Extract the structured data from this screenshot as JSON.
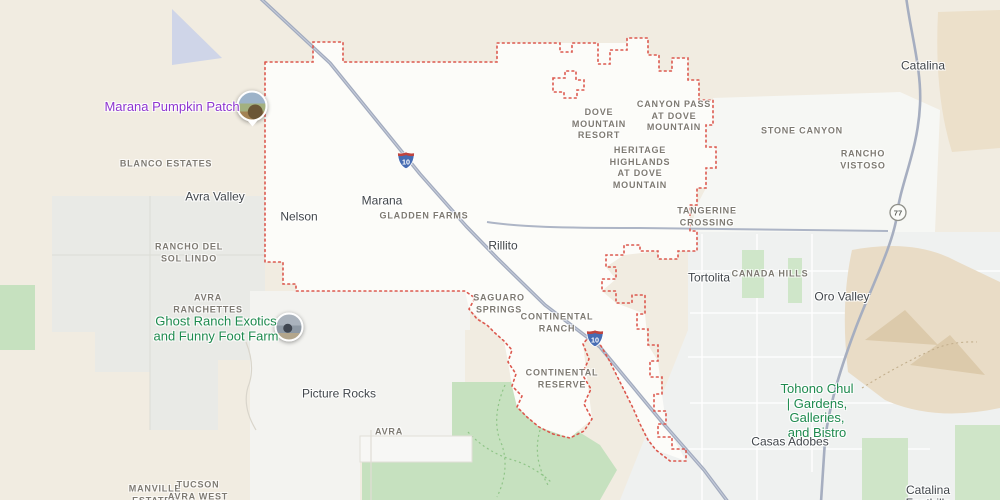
{
  "map": {
    "description": "road map with dotted municipal boundary",
    "colors": {
      "land": "#f1ece1",
      "urban_white": "#fcfcf9",
      "suburb_gray": "#eff1f0",
      "park_green": "#c6e1bf",
      "terrain_tan": "#e9dcc6",
      "blue_area": "#cfd5e8",
      "road_major": "#a2abbe",
      "boundary_red": "#dc584e",
      "poi_purple": "#8e35d0",
      "poi_green": "#1e8a4e"
    },
    "labels": [
      {
        "name": "marana-pumpkin-patch-label",
        "type": "poi-purple",
        "x": 172,
        "y": 107,
        "lines": [
          "Marana Pumpkin Patch"
        ]
      },
      {
        "name": "blanco-estates-label",
        "type": "area-caps",
        "x": 166,
        "y": 164,
        "lines": [
          "BLANCO ESTATES"
        ]
      },
      {
        "name": "avra-valley-label",
        "type": "locality",
        "x": 215,
        "y": 197,
        "lines": [
          "Avra Valley"
        ]
      },
      {
        "name": "rancho-del-sol-lindo-label",
        "type": "area-caps",
        "x": 189,
        "y": 253,
        "lines": [
          "RANCHO DEL",
          "SOL LINDO"
        ]
      },
      {
        "name": "avra-ranchettes-label",
        "type": "area-caps",
        "x": 208,
        "y": 304,
        "lines": [
          "AVRA",
          "RANCHETTES"
        ]
      },
      {
        "name": "ghost-ranch-label",
        "type": "poi-green",
        "x": 216,
        "y": 329,
        "lines": [
          "Ghost Ranch Exotics",
          "and Funny Foot Farm"
        ]
      },
      {
        "name": "picture-rocks-label",
        "type": "locality",
        "x": 339,
        "y": 394,
        "lines": [
          "Picture Rocks"
        ]
      },
      {
        "name": "avra-label",
        "type": "area-caps",
        "x": 389,
        "y": 432,
        "lines": [
          "AVRA"
        ]
      },
      {
        "name": "manville-estates-label",
        "type": "area-caps",
        "x": 155,
        "y": 495,
        "lines": [
          "MANVILLE",
          "ESTATES"
        ]
      },
      {
        "name": "tucson-avra-west-label",
        "type": "area-caps",
        "x": 198,
        "y": 491,
        "lines": [
          "TUCSON",
          "AVRA WEST"
        ]
      },
      {
        "name": "nelson-label",
        "type": "locality",
        "x": 299,
        "y": 217,
        "lines": [
          "Nelson"
        ]
      },
      {
        "name": "marana-label",
        "type": "locality",
        "x": 382,
        "y": 201,
        "lines": [
          "Marana"
        ]
      },
      {
        "name": "gladden-farms-label",
        "type": "area-caps",
        "x": 424,
        "y": 216,
        "lines": [
          "GLADDEN FARMS"
        ]
      },
      {
        "name": "rillito-label",
        "type": "locality",
        "x": 503,
        "y": 246,
        "lines": [
          "Rillito"
        ]
      },
      {
        "name": "saguaro-springs-label",
        "type": "area-caps",
        "x": 499,
        "y": 304,
        "lines": [
          "SAGUARO",
          "SPRINGS"
        ]
      },
      {
        "name": "continental-ranch-label",
        "type": "area-caps",
        "x": 557,
        "y": 323,
        "lines": [
          "CONTINENTAL",
          "RANCH"
        ]
      },
      {
        "name": "continental-reserve-label",
        "type": "area-caps",
        "x": 562,
        "y": 379,
        "lines": [
          "CONTINENTAL",
          "RESERVE"
        ]
      },
      {
        "name": "dove-mountain-resort-label",
        "type": "area-caps",
        "x": 599,
        "y": 124,
        "lines": [
          "DOVE",
          "MOUNTAIN",
          "RESORT"
        ]
      },
      {
        "name": "canyon-pass-at-dove-mountain-label",
        "type": "area-caps",
        "x": 674,
        "y": 116,
        "lines": [
          "CANYON PASS",
          "AT DOVE",
          "MOUNTAIN"
        ]
      },
      {
        "name": "heritage-highlands-at-dove-mountain-label",
        "type": "area-caps",
        "x": 640,
        "y": 168,
        "lines": [
          "HERITAGE",
          "HIGHLANDS",
          "AT DOVE",
          "MOUNTAIN"
        ]
      },
      {
        "name": "tangerine-crossing-label",
        "type": "area-caps",
        "x": 707,
        "y": 217,
        "lines": [
          "TANGERINE",
          "CROSSING"
        ]
      },
      {
        "name": "tortolita-label",
        "type": "locality",
        "x": 709,
        "y": 278,
        "lines": [
          "Tortolita"
        ]
      },
      {
        "name": "canada-hills-label",
        "type": "area-caps",
        "x": 770,
        "y": 274,
        "lines": [
          "CANADA HILLS"
        ]
      },
      {
        "name": "stone-canyon-label",
        "type": "area-caps",
        "x": 802,
        "y": 131,
        "lines": [
          "STONE CANYON"
        ]
      },
      {
        "name": "rancho-vistoso-label",
        "type": "area-caps",
        "x": 863,
        "y": 160,
        "lines": [
          "RANCHO",
          "VISTOSO"
        ]
      },
      {
        "name": "oro-valley-label",
        "type": "locality",
        "x": 842,
        "y": 297,
        "lines": [
          "Oro Valley"
        ]
      },
      {
        "name": "catalina-label",
        "type": "locality",
        "x": 923,
        "y": 66,
        "lines": [
          "Catalina"
        ]
      },
      {
        "name": "tohono-chul-label",
        "type": "poi-green",
        "x": 817,
        "y": 411,
        "lines": [
          "Tohono Chul",
          "| Gardens,",
          "Galleries,",
          "and Bistro"
        ]
      },
      {
        "name": "casas-adobes-label",
        "type": "locality",
        "x": 790,
        "y": 442,
        "lines": [
          "Casas Adobes"
        ]
      },
      {
        "name": "catalina-foothills-label",
        "type": "locality",
        "x": 928,
        "y": 497,
        "lines": [
          "Catalina",
          "Foothills"
        ]
      }
    ],
    "shields": [
      {
        "name": "interstate-10-shield",
        "type": "interstate",
        "label": "10",
        "x": 406,
        "y": 163
      },
      {
        "name": "interstate-10-shield",
        "type": "interstate",
        "label": "10",
        "x": 595,
        "y": 341
      },
      {
        "name": "state-route-77-shield",
        "type": "circle",
        "label": "77",
        "x": 898,
        "y": 215
      }
    ],
    "markers": [
      {
        "name": "marana-pumpkin-patch-photo-marker",
        "x": 252,
        "y": 106,
        "size": 27,
        "pointer": true,
        "photo": "pumpkin-field"
      },
      {
        "name": "ghost-ranch-photo-marker",
        "x": 289,
        "y": 327,
        "size": 25,
        "pointer": false,
        "photo": "ranch-animals"
      }
    ]
  }
}
